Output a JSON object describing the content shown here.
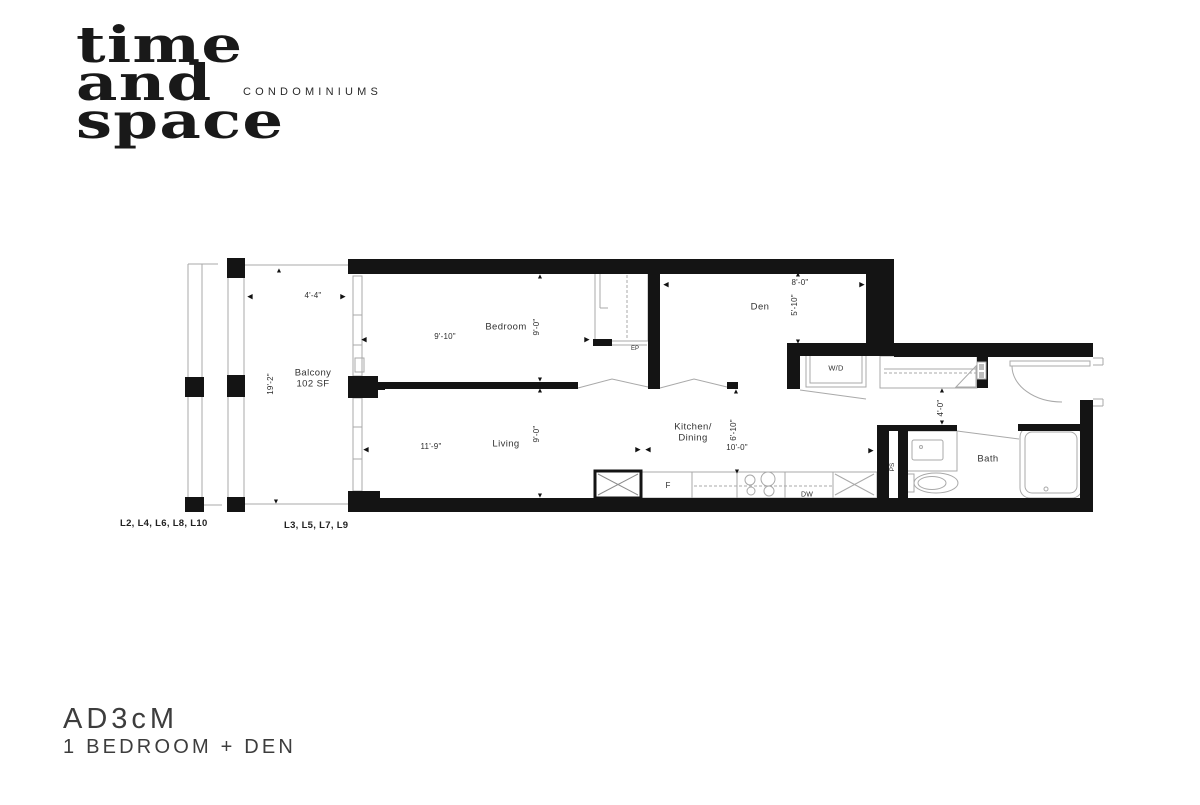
{
  "brand": {
    "word1": "time",
    "word2": "and",
    "word3": "space",
    "tagline": "CONDOMINIUMS"
  },
  "unit": {
    "code": "AD3cM",
    "type": "1 BEDROOM + DEN"
  },
  "levels": {
    "even": "L2, L4, L6, L8, L10",
    "odd": "L3, L5, L7, L9"
  },
  "rooms": {
    "balcony": {
      "name": "Balcony",
      "area": "102 SF",
      "width": "4'-4\"",
      "depth": "19'-2\""
    },
    "bedroom": {
      "name": "Bedroom",
      "width": "9'-10\"",
      "depth": "9'-0\""
    },
    "living": {
      "name": "Living",
      "width": "11'-9\"",
      "depth": "9'-0\""
    },
    "den": {
      "name": "Den",
      "width": "8'-0\"",
      "depth": "5'-10\""
    },
    "kitchen": {
      "name_line1": "Kitchen/",
      "name_line2": "Dining",
      "width": "10'-0\"",
      "depth": "6'-10\""
    },
    "bath": {
      "name": "Bath"
    },
    "hall": {
      "width": "4'-0\""
    }
  },
  "fixtures": {
    "washer_dryer": "W/D",
    "electrical_panel": "EP",
    "pipe_shaft": "PS",
    "fridge": "F",
    "dishwasher": "DW"
  },
  "icons": {
    "arrow_up": "▲",
    "arrow_down": "▼",
    "arrow_left": "◀",
    "arrow_right": "▶"
  },
  "colors": {
    "wall": "#141414",
    "thin_line": "#a9a9a9",
    "text": "#2e2e2e"
  }
}
